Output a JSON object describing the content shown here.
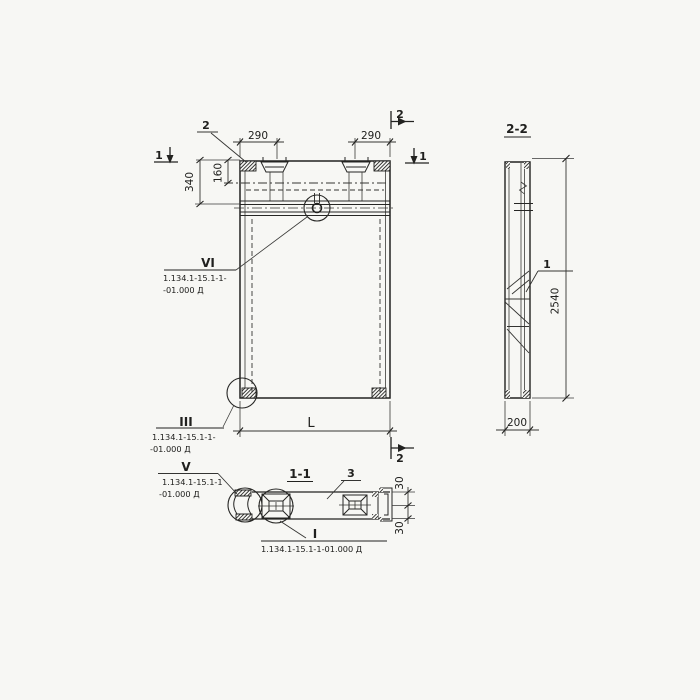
{
  "drawing_type": "precast concrete panel working drawing",
  "front_view": {
    "callout_2": "2",
    "dims": {
      "d290_left": "290",
      "d290_right": "290",
      "d340": "340",
      "d160": "160",
      "dL": "L"
    },
    "section_marks": {
      "s1_left": "1",
      "s1_right": "1",
      "s2_top": "2",
      "s2_bottom": "2"
    },
    "details": {
      "vi": {
        "numeral": "VI",
        "ref1": "1.134.1-15.1-1-",
        "ref2": "-01.000 Д"
      },
      "iii": {
        "numeral": "III",
        "ref1": "1.134.1-15.1-1-",
        "ref2": "-01.000 Д"
      }
    }
  },
  "section_2_2": {
    "title": "2-2",
    "callout_1": "1",
    "dims": {
      "d2540": "2540",
      "d200": "200"
    }
  },
  "section_1_1": {
    "title": "1-1",
    "callout_3": "3",
    "dims": {
      "d30_top": "30",
      "d30_bottom": "30"
    },
    "details": {
      "v": {
        "numeral": "V",
        "ref1": "1.134.1-15.1-1",
        "ref2": "-01.000 Д"
      },
      "i": {
        "numeral": "I",
        "ref": "1.134.1-15.1-1-01.000 Д"
      }
    }
  }
}
